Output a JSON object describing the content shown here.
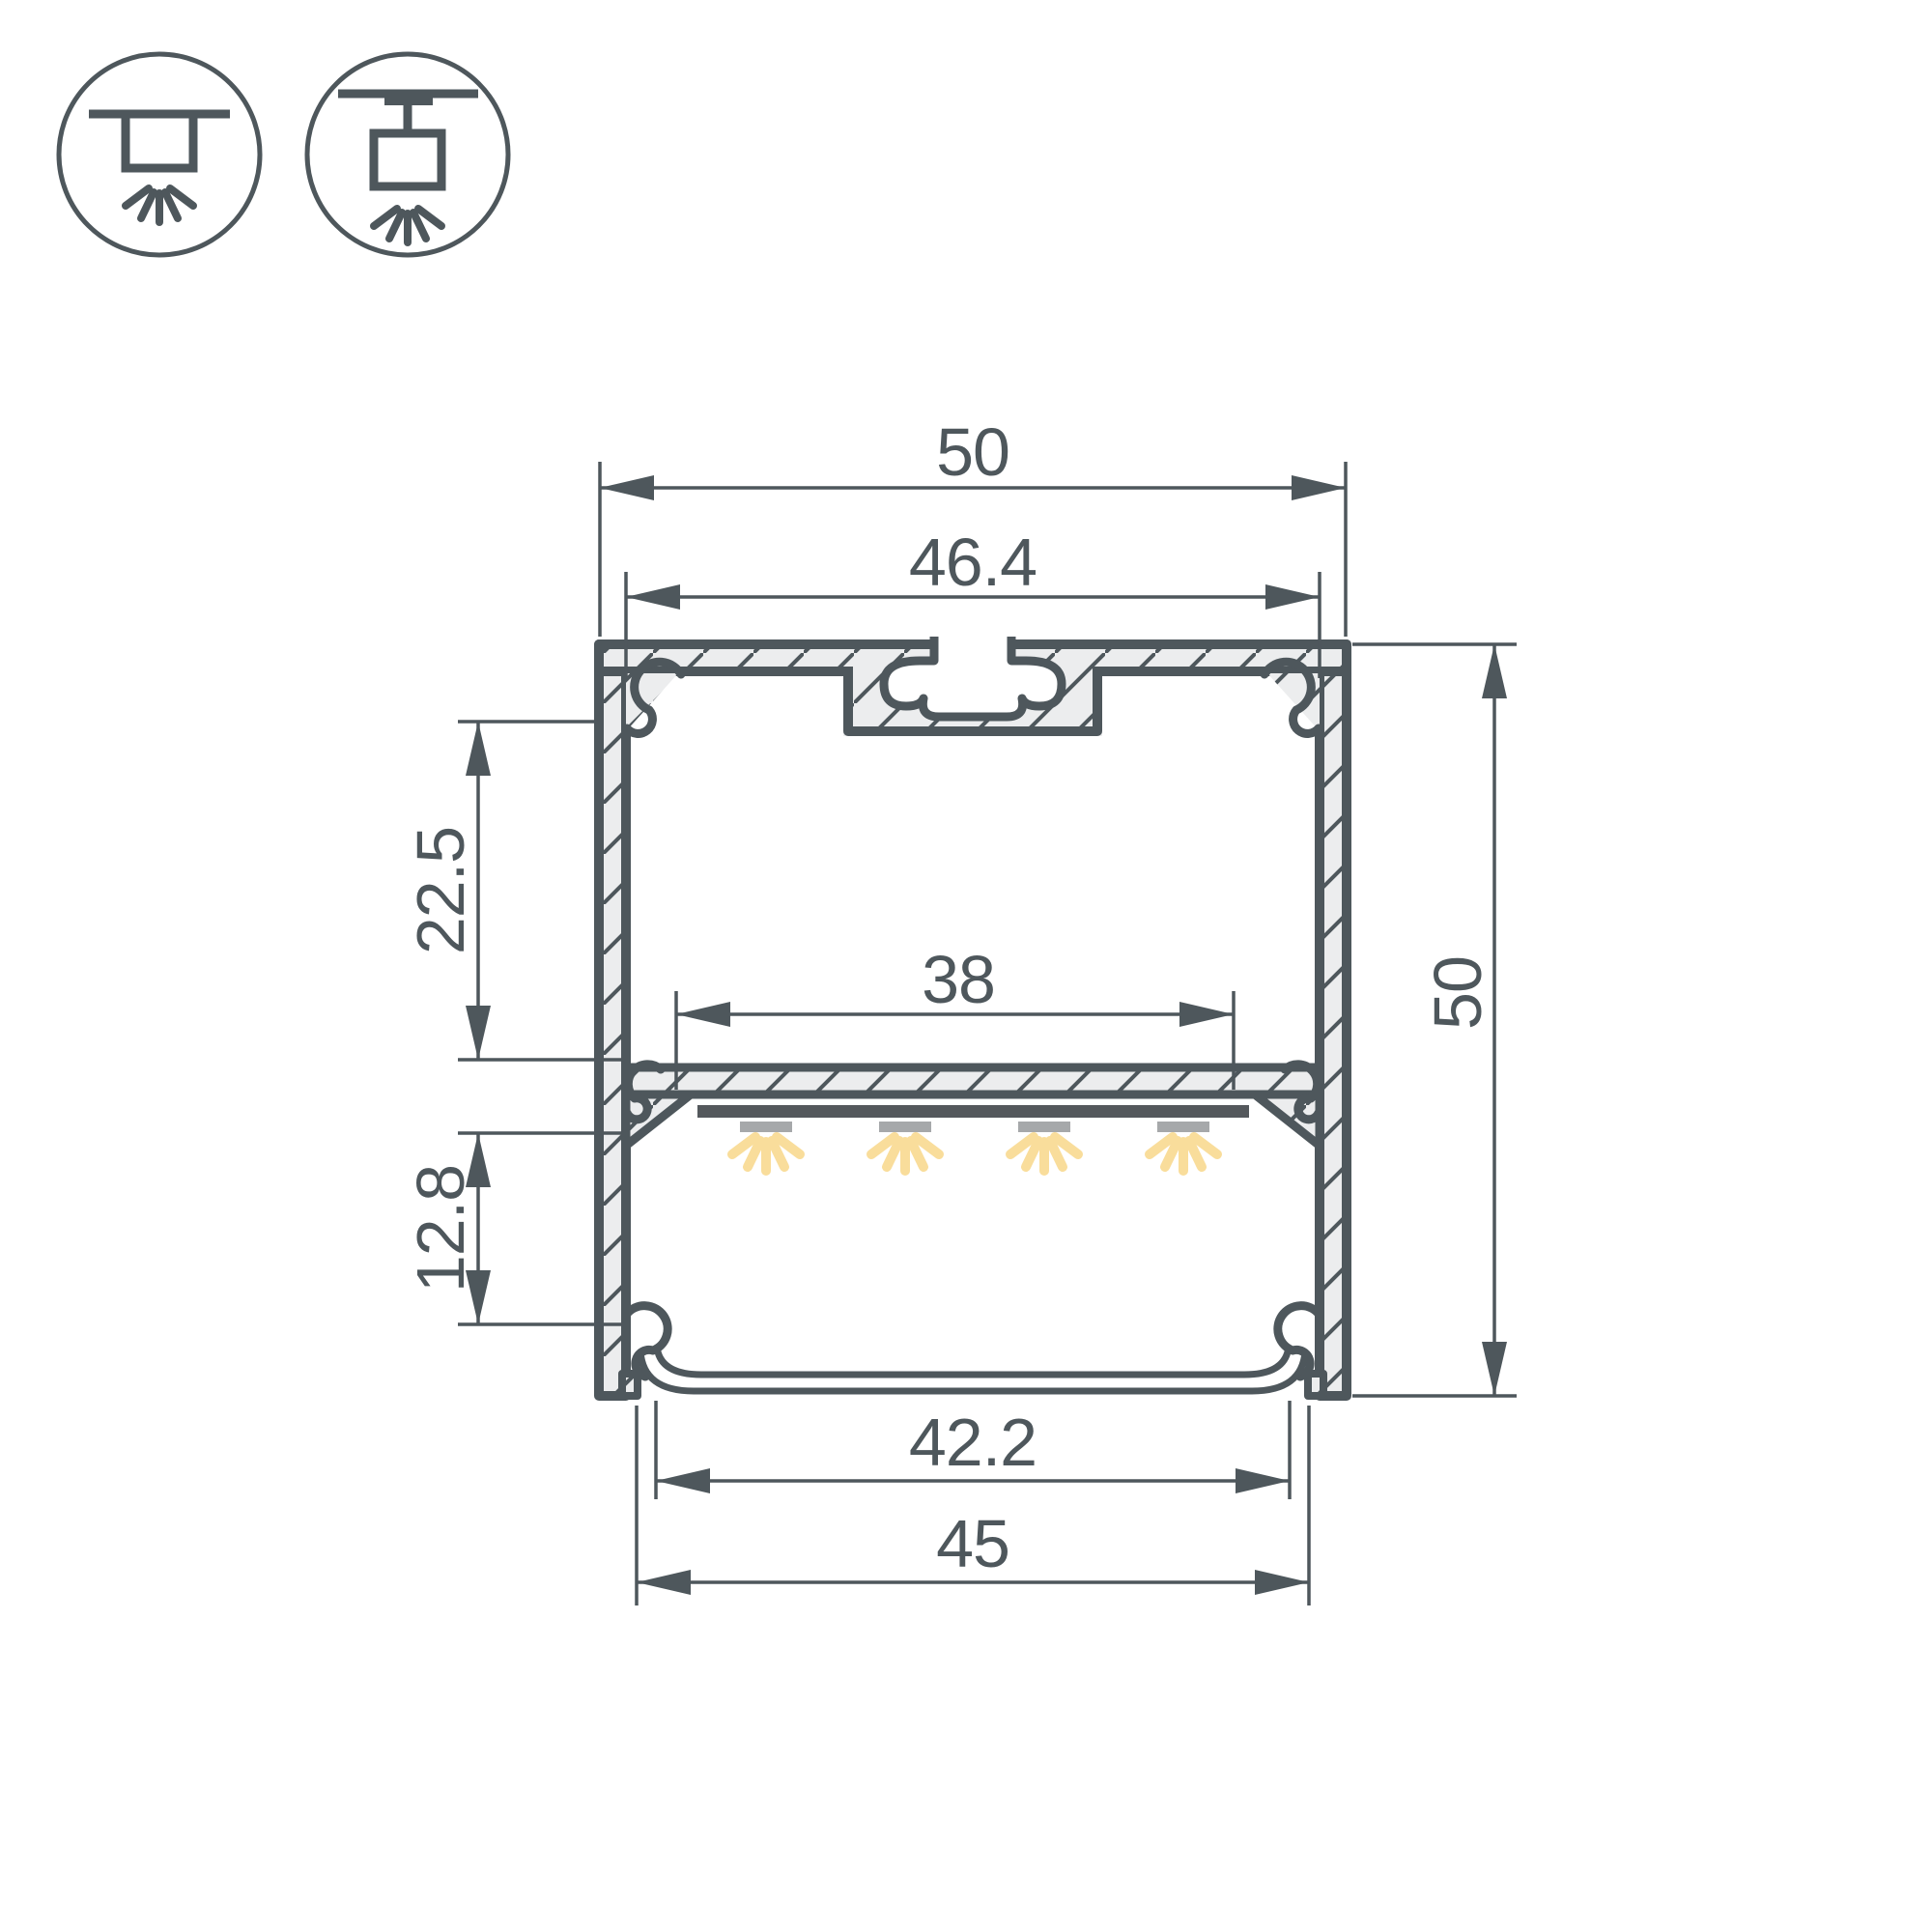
{
  "drawing": {
    "title": "led-profile-cross-section",
    "dimensions": {
      "outer_width": "50",
      "top_inner_width": "46.4",
      "upper_chamber_depth": "22.5",
      "led_platform_width": "38",
      "lower_chamber_depth": "12.8",
      "outer_height": "50",
      "diffuser_inner_width": "42.2",
      "diffuser_width": "45"
    },
    "icons": {
      "first": "surface-ceiling-mount",
      "second": "suspended-mount"
    },
    "colors": {
      "line": "#4E575C",
      "material_fill": "#ECEDEE",
      "led_bar": "#54585C",
      "led_module": "#A6A8AA",
      "light_ray": "#F9DD9B",
      "background": "#FFFFFF"
    }
  }
}
